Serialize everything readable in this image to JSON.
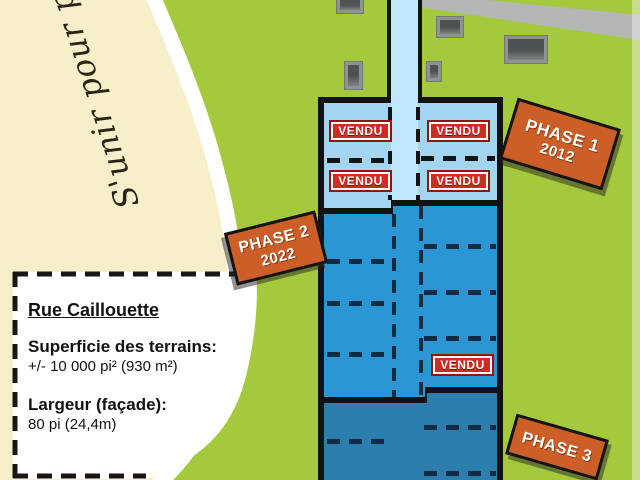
{
  "motto": {
    "script_text": "S'unir pour pr"
  },
  "info_box": {
    "street_name": "Rue Caillouette",
    "area_label": "Superficie des terrains:",
    "area_value": "+/- 10 000 pi² (930 m²)",
    "frontage_label": "Largeur (façade):",
    "frontage_value": "80 pi (24,4m)"
  },
  "signs": {
    "phase1": {
      "name": "PHASE 1",
      "year": "2012"
    },
    "phase2": {
      "name": "PHASE 2",
      "year": "2022"
    },
    "phase3": {
      "name": "PHASE 3"
    }
  },
  "lots": {
    "sold_label": "VENDU",
    "sold_count": 5
  },
  "colors": {
    "background_green": "#A5C93C",
    "cream": "#F6EFCA",
    "phase1_blue": "#A4D5F0",
    "street_blue": "#C0E7FA",
    "phase2_blue": "#2A96D3",
    "phase3_blue": "#2C7EAC",
    "sold_red": "#CE2B24",
    "sign_orange": "#CC5F28",
    "road_gray": "#B4B7B6"
  }
}
